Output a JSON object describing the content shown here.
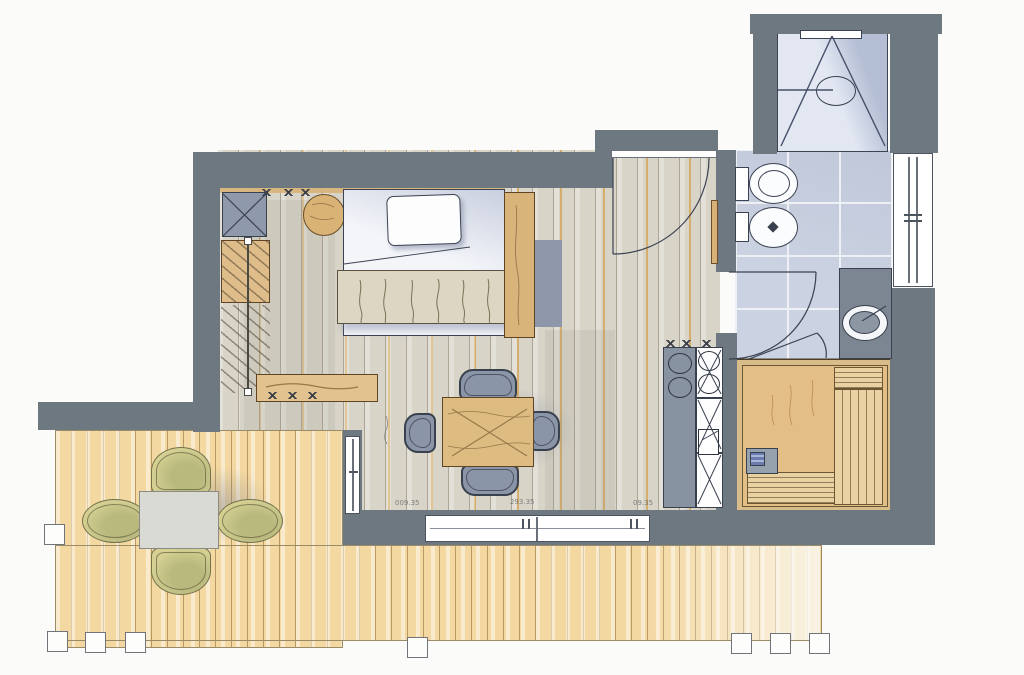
{
  "plan": {
    "kind": "hand-rendered apartment floor plan (no room labels printed)",
    "annotations": [
      {
        "text": "009.35"
      },
      {
        "text": "293.35"
      },
      {
        "text": "09.35"
      }
    ],
    "colors": {
      "wall": "#6d7880",
      "ink": "#3b4252",
      "floor_base": "#d8d4c8",
      "deck_base": "#f3d8a1",
      "tile_base": "#cbd2e1",
      "tile_joint": "#eef0f6",
      "shower_base": "#e2e7f2",
      "shower_shade": "#b4bed4",
      "wood": "#dcb87e",
      "sauna_floor": "#e3bf87",
      "sauna_frame": "#d8bd8b",
      "sauna_bench": "#e9d1a2",
      "counter": "#8793a1",
      "chair_blue": "#8b95a8",
      "chair_blue_dark": "#39404e",
      "olive": "#d6d093",
      "olive_dark": "#73734c",
      "olive_dark2": "#b9b97e",
      "vanity": "#7b8692",
      "heater": "#96a1ae",
      "annotation": "#6f6f6f"
    }
  }
}
